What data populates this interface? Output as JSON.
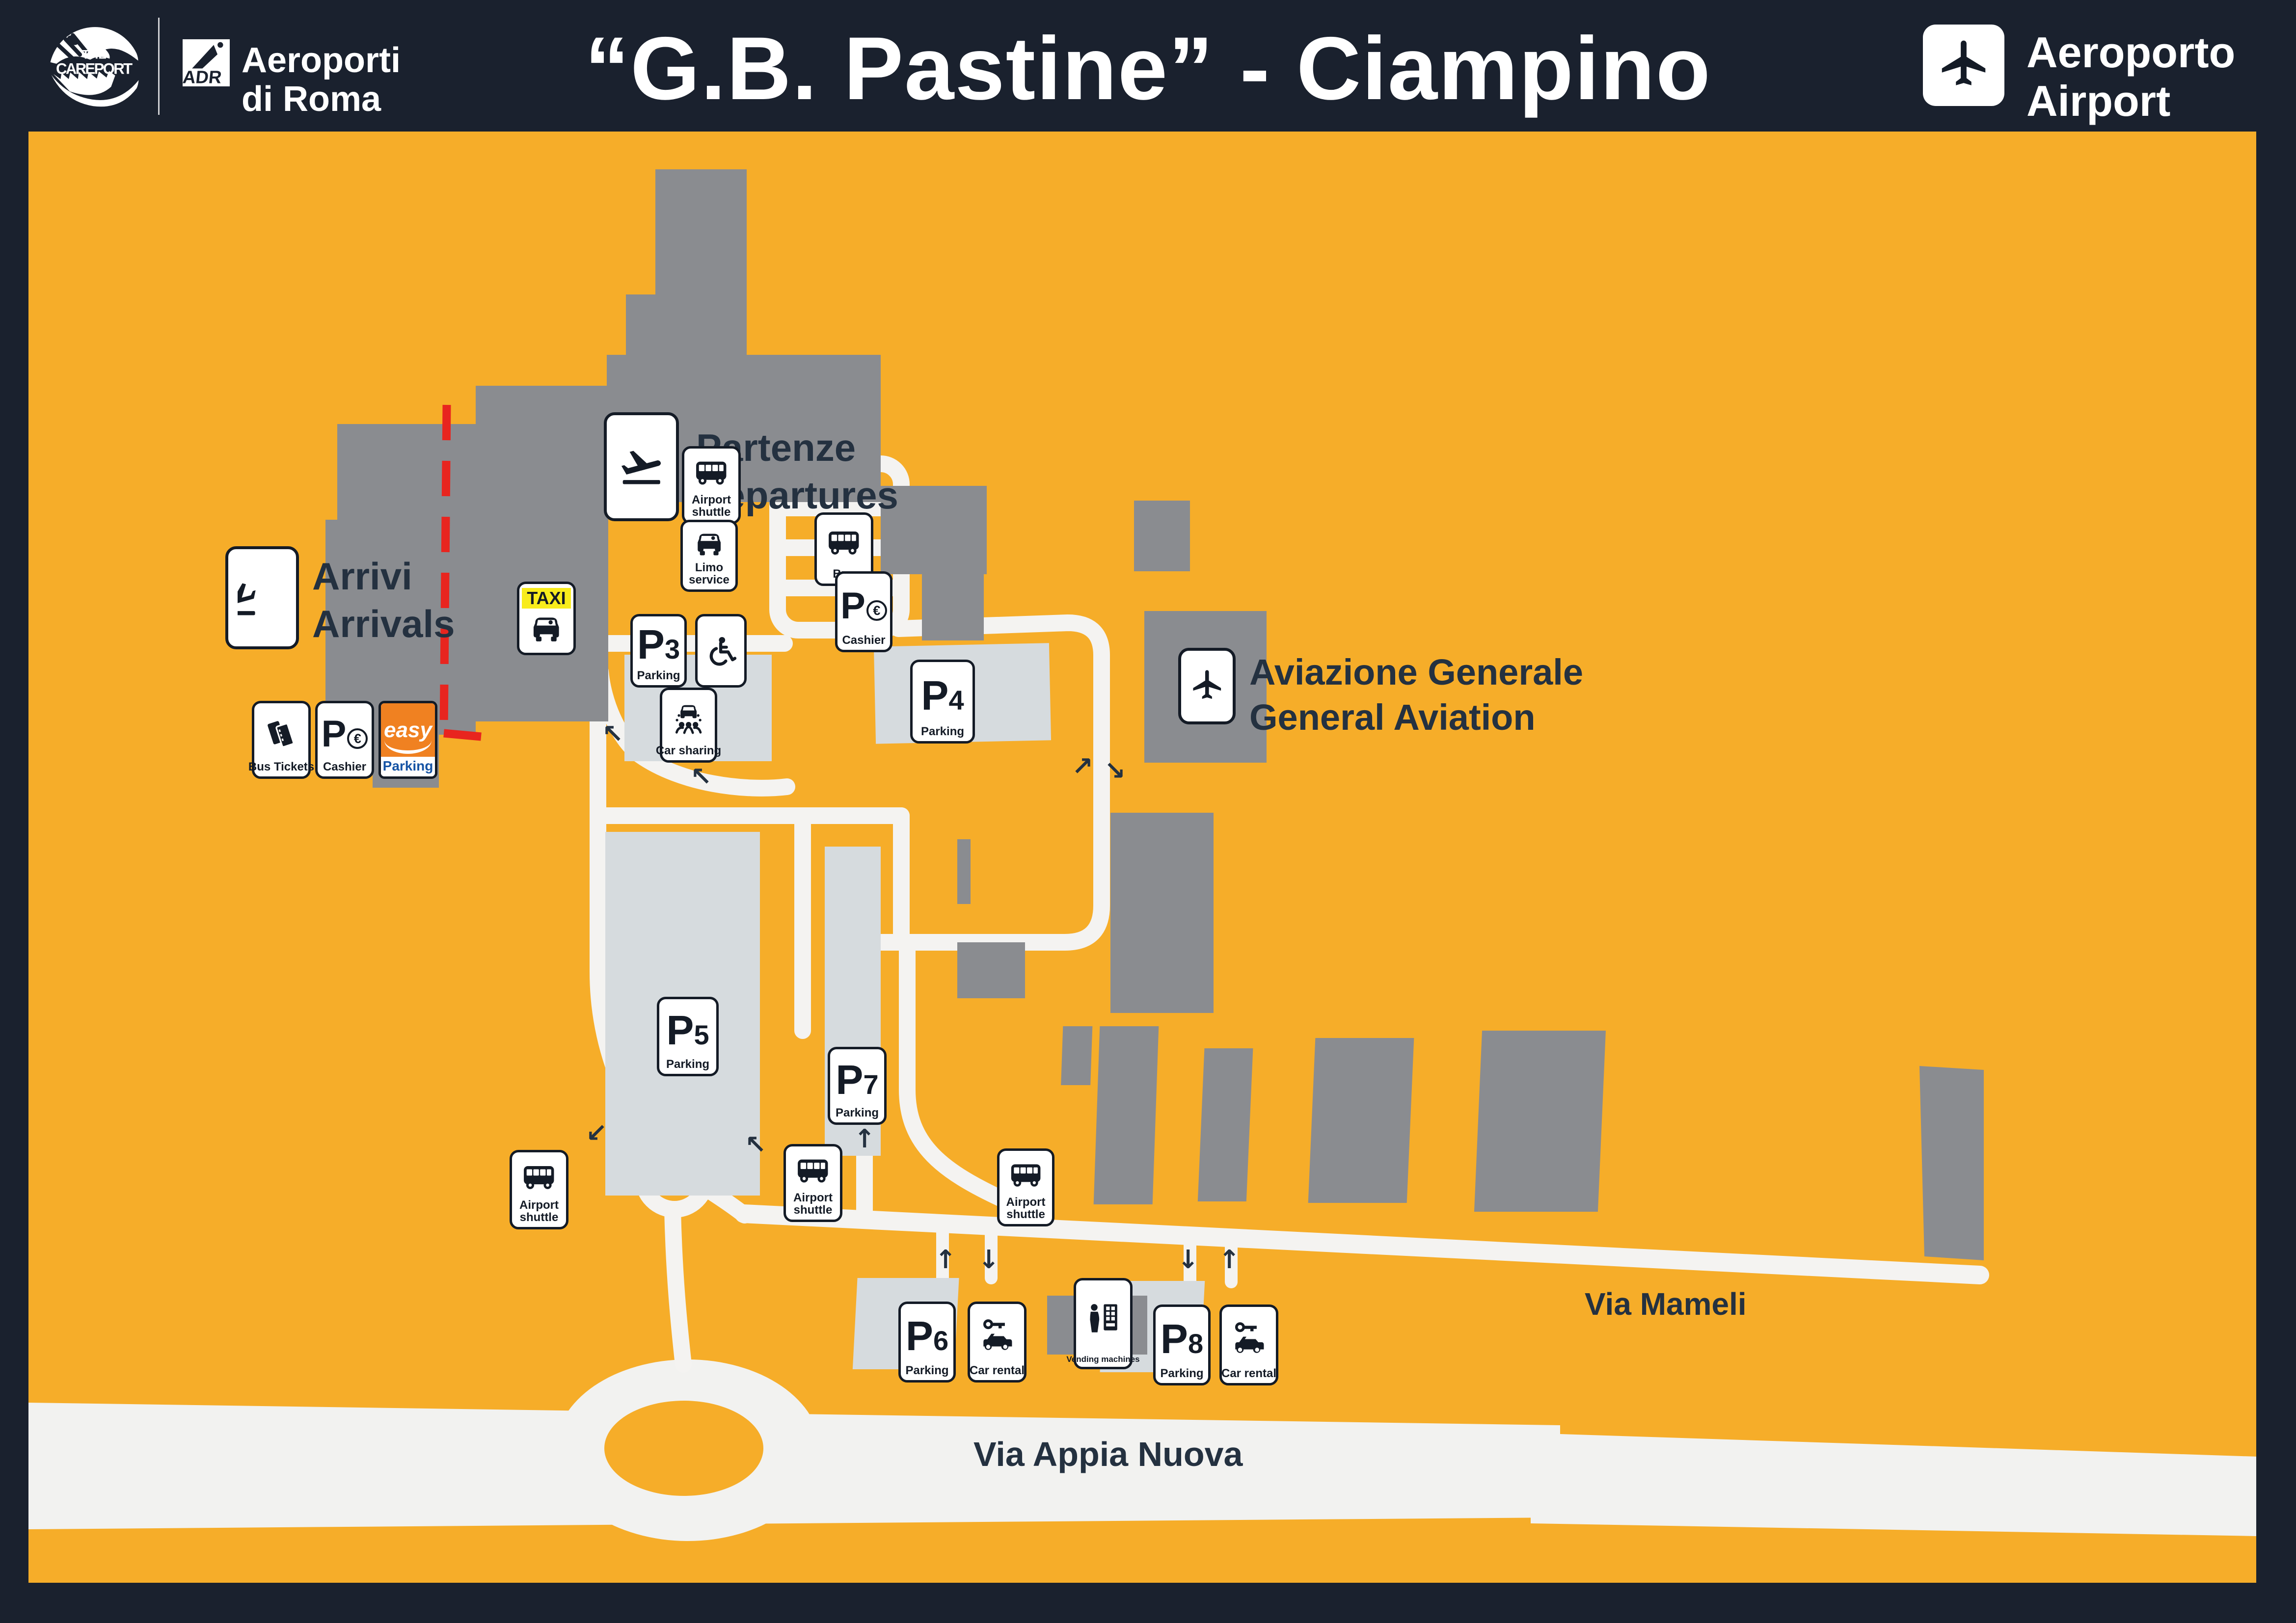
{
  "colors": {
    "header_navy": "#1A212E",
    "map_orange": "#F6AD29",
    "building_gray": "#8A8C90",
    "parking_gray": "#D6DBDE",
    "road_white": "#F4F3F1",
    "label_navy": "#243140",
    "red_dash": "#E8251F",
    "taxi_yellow": "#F8EC1C",
    "easy_orange": "#F08121",
    "easy_blue": "#1553A4"
  },
  "header": {
    "careport_the": "THE",
    "careport_name": "CAREPORT",
    "adr_abbr": "ADR",
    "adr_line1": "Aeroporti",
    "adr_line2": "di Roma",
    "title": "“G.B. Pastine” - Ciampino",
    "airport_line1": "Aeroporto",
    "airport_line2": "Airport"
  },
  "map": {
    "labels": {
      "partenze_it": "Partenze",
      "partenze_en": "Departures",
      "arrivi_it": "Arrivi",
      "arrivi_en": "Arrivals",
      "ga_it": "Aviazione Generale",
      "ga_en": "General Aviation",
      "via_mameli": "Via Mameli",
      "via_appia": "Via Appia Nuova"
    },
    "badges": {
      "bus_tickets": {
        "label": "Bus Tickets"
      },
      "cashier_terminal": {
        "p": "P",
        "cur": "€",
        "label": "Cashier"
      },
      "easy_parking": {
        "top": "easy",
        "bottom": "Parking"
      },
      "taxi": {
        "label": "TAXI"
      },
      "shuttle_terminal": {
        "label": "Airport shuttle"
      },
      "limo": {
        "label": "Limo service"
      },
      "bus": {
        "label": "Bus"
      },
      "cashier_p4": {
        "p": "P",
        "cur": "€",
        "label": "Cashier"
      },
      "p3": {
        "p": "P",
        "num": "3",
        "label": "Parking"
      },
      "car_sharing": {
        "label": "Car sharing"
      },
      "p4": {
        "p": "P",
        "num": "4",
        "label": "Parking"
      },
      "p5": {
        "p": "P",
        "num": "5",
        "label": "Parking"
      },
      "p7": {
        "p": "P",
        "num": "7",
        "label": "Parking"
      },
      "shuttle_p5": {
        "label": "Airport shuttle"
      },
      "shuttle_p7": {
        "label": "Airport shuttle"
      },
      "shuttle_mameli": {
        "label": "Airport shuttle"
      },
      "p6": {
        "p": "P",
        "num": "6",
        "label": "Parking"
      },
      "car_rental_p6": {
        "label": "Car rental"
      },
      "vending": {
        "label": "Vending machines"
      },
      "p8": {
        "p": "P",
        "num": "8",
        "label": "Parking"
      },
      "car_rental_p8": {
        "label": "Car rental"
      }
    }
  }
}
